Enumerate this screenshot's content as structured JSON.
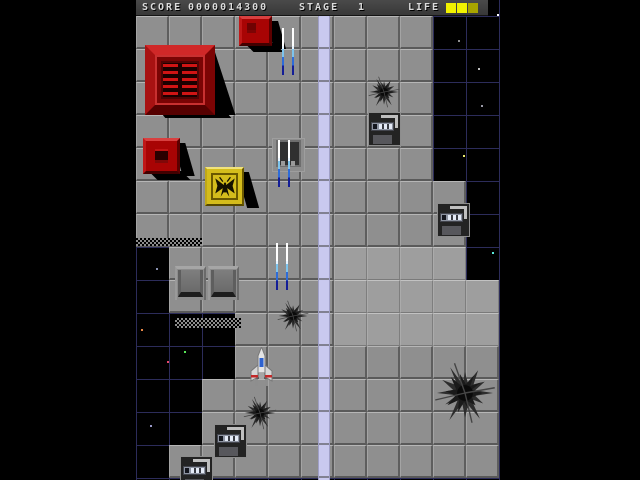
{
  "hud": {
    "score_label": "SCORE",
    "score_value": "0000014300",
    "stage_label": "STAGE",
    "stage_value": "1",
    "life_label": "LIFE",
    "life_cells": [
      "#f2f200",
      "#f2f200",
      "#a8a400"
    ]
  },
  "colors": {
    "space": "#000000",
    "space_grid": "#2c2c5a",
    "floor_tile": "#8f8f8f",
    "platform_tile": "#9e9e9e",
    "road": "#c9c9ef",
    "red_block": "#a80404",
    "yellow_block": "#d4bc1c",
    "bullet_white": "#ffffff",
    "bullet_blue": "#2e6cd8",
    "hud_bg": "#424242",
    "life_yellow": "#f2f200"
  },
  "playfield": {
    "tile_size": 33,
    "tiles_top": 16,
    "grid_color": "#2c2c5a",
    "road": {
      "x": 182,
      "y": 16,
      "width": 12,
      "height": 464,
      "color": "#c9c9ef"
    },
    "tile_map": [
      "GGGGGGGGGBB",
      "GGGGGGGGGBB",
      "GGGGGGGGGBB",
      "GGGGGGGGGBB",
      "GGGGGGGGGBB",
      "GGGGGGGGGGB",
      "GGGGGGGGGGB",
      "BGGGGGPPPPB",
      "BGGGGGPPPPP",
      "BBBGGGPPPPP",
      "BBBGGGGGGGG",
      "BBGGGGGGGGG",
      "BBGGGGGGGGG",
      "BGGGGGGGGGG"
    ],
    "stars": [
      {
        "x": 330,
        "y": 5,
        "color": "#ff8a3c"
      },
      {
        "x": 361,
        "y": 14,
        "color": "#ffffff"
      },
      {
        "x": 322,
        "y": 40,
        "color": "#909090"
      },
      {
        "x": 342,
        "y": 68,
        "color": "#c0c0c0"
      },
      {
        "x": 345,
        "y": 105,
        "color": "#9a9aa8"
      },
      {
        "x": 327,
        "y": 155,
        "color": "#e8e870"
      },
      {
        "x": 356,
        "y": 252,
        "color": "#58e8d8"
      },
      {
        "x": 20,
        "y": 268,
        "color": "#8890b0"
      },
      {
        "x": 5,
        "y": 329,
        "color": "#e88848"
      },
      {
        "x": 48,
        "y": 351,
        "color": "#58e858"
      },
      {
        "x": 31,
        "y": 361,
        "color": "#e84868"
      },
      {
        "x": 101,
        "y": 373,
        "color": "#bdbdbd"
      },
      {
        "x": 14,
        "y": 425,
        "color": "#9898c8"
      }
    ],
    "sprites": [
      {
        "type": "dither",
        "name": "terrain-dither-edge",
        "x": 0,
        "y": 238,
        "w": 66,
        "h": 8
      },
      {
        "type": "dither",
        "name": "terrain-dither-edge",
        "x": 39,
        "y": 318,
        "w": 66,
        "h": 10
      },
      {
        "type": "burst",
        "name": "scorch-mark",
        "x": 230,
        "y": 74,
        "w": 36,
        "h": 36
      },
      {
        "type": "burst",
        "name": "scorch-mark",
        "x": 139,
        "y": 298,
        "w": 36,
        "h": 36
      },
      {
        "type": "burst",
        "name": "scorch-mark",
        "x": 105,
        "y": 394,
        "w": 38,
        "h": 38
      },
      {
        "type": "burst",
        "name": "scorch-mark-large",
        "x": 293,
        "y": 358,
        "w": 72,
        "h": 70
      },
      {
        "type": "pyramid",
        "name": "red-pyramid-structure",
        "x": 9,
        "y": 45,
        "w": 70,
        "h": 70
      },
      {
        "type": "redbox",
        "name": "red-block",
        "x": 103,
        "y": 16,
        "w": 33,
        "h": 30,
        "grate": false
      },
      {
        "type": "redbox",
        "name": "red-block-small",
        "x": 7,
        "y": 138,
        "w": 37,
        "h": 36,
        "grate": true
      },
      {
        "type": "yellowbox",
        "name": "yellow-emblem-block",
        "x": 69,
        "y": 167,
        "w": 39,
        "h": 39
      },
      {
        "type": "hatch",
        "name": "hatch-tile",
        "x": 136,
        "y": 138,
        "w": 33,
        "h": 34
      },
      {
        "type": "console",
        "name": "console-tile",
        "x": 232,
        "y": 112,
        "w": 33,
        "h": 34
      },
      {
        "type": "console",
        "name": "console-tile",
        "x": 301,
        "y": 203,
        "w": 33,
        "h": 34
      },
      {
        "type": "console",
        "name": "console-tile",
        "x": 78,
        "y": 424,
        "w": 33,
        "h": 34
      },
      {
        "type": "console",
        "name": "console-tile",
        "x": 44,
        "y": 456,
        "w": 33,
        "h": 34
      },
      {
        "type": "door",
        "name": "door-tile",
        "x": 39,
        "y": 266,
        "w": 31,
        "h": 34
      },
      {
        "type": "door",
        "name": "door-tile",
        "x": 72,
        "y": 266,
        "w": 31,
        "h": 34
      },
      {
        "type": "bullets",
        "name": "player-shots",
        "x": 146,
        "y": 28,
        "w": 12,
        "h": 47
      },
      {
        "type": "bullets",
        "name": "player-shots",
        "x": 142,
        "y": 140,
        "w": 12,
        "h": 47
      },
      {
        "type": "bullets",
        "name": "player-shots",
        "x": 140,
        "y": 243,
        "w": 12,
        "h": 47
      },
      {
        "type": "ship",
        "name": "player-ship",
        "x": 113,
        "y": 347,
        "w": 25,
        "h": 40
      }
    ]
  }
}
